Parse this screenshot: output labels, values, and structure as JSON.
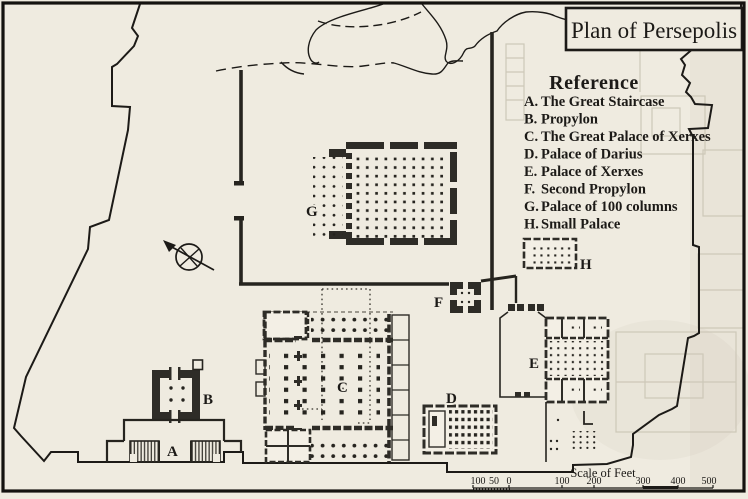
{
  "title": "Plan of Persepolis",
  "reference": {
    "heading": "Reference",
    "items": [
      {
        "key": "A.",
        "label": "The Great Staircase"
      },
      {
        "key": "B.",
        "label": "Propylon"
      },
      {
        "key": "C.",
        "label": "The Great Palace of Xerxes"
      },
      {
        "key": "D.",
        "label": "Palace of Darius"
      },
      {
        "key": "E.",
        "label": "Palace of Xerxes"
      },
      {
        "key": "F.",
        "label": "Second Propylon"
      },
      {
        "key": "G.",
        "label": "Palace of 100 columns"
      },
      {
        "key": "H.",
        "label": "Small Palace"
      }
    ]
  },
  "plan_marks": {
    "a": "A",
    "b": "B",
    "c": "C",
    "d": "D",
    "e": "E",
    "f": "F",
    "g": "G",
    "h": "H"
  },
  "scale": {
    "caption": "Scale of Feet",
    "ticks": [
      "100",
      "50",
      "0",
      "100",
      "200",
      "300",
      "400",
      "500"
    ]
  },
  "colors": {
    "paper": "#efebe0",
    "ink": "#1c1a17",
    "wall": "#2e2c27",
    "ghost": "#cdc8b8"
  }
}
